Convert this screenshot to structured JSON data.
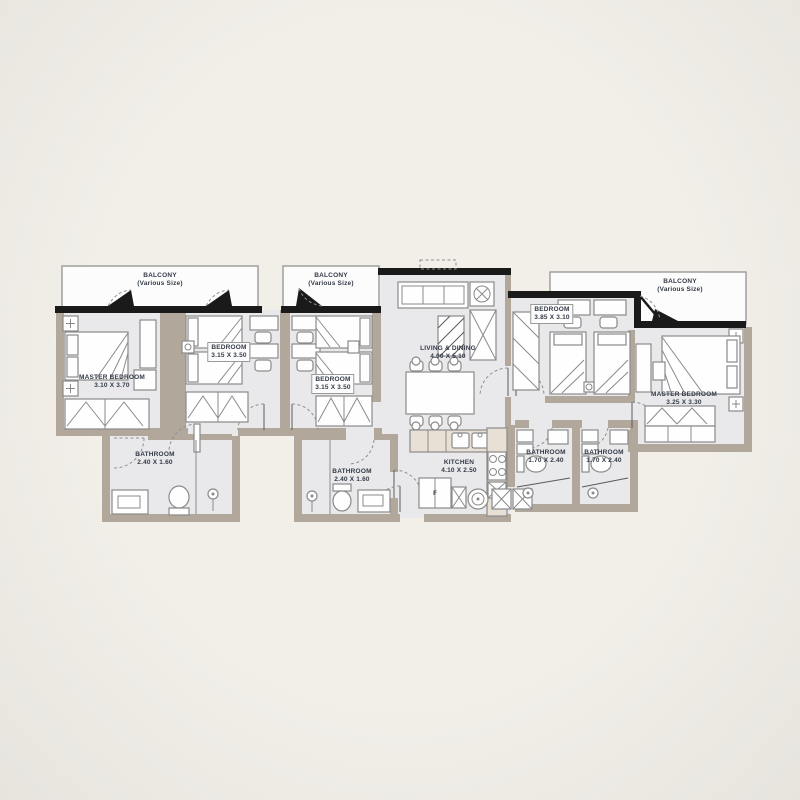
{
  "colors": {
    "outside": "#efece7",
    "floor": "#e9e9ec",
    "wall": "#b1a79b",
    "black": "#1a1a1a",
    "line": "#8a8a8a",
    "counter": "#e8e0d4",
    "text": "#333a47"
  },
  "plan": {
    "balcony_left": {
      "name": "BALCONY",
      "dims": "(Various Size)"
    },
    "balcony_mid": {
      "name": "BALCONY",
      "dims": "(Various Size)"
    },
    "balcony_right": {
      "name": "BALCONY",
      "dims": "(Various Size)"
    },
    "master_left": {
      "name": "MASTER BEDROOM",
      "dims": "3.10 X 3.70"
    },
    "bedroom_left": {
      "name": "BEDROOM",
      "dims": "3.15 X 3.50"
    },
    "bedroom_mid": {
      "name": "BEDROOM",
      "dims": "3.15 X 3.50"
    },
    "living": {
      "name": "LIVING & DINING",
      "dims": "4.00 X 5.10"
    },
    "bedroom_right": {
      "name": "BEDROOM",
      "dims": "3.85 X 3.10"
    },
    "master_right": {
      "name": "MASTER BEDROOM",
      "dims": "3.25 X 3.30"
    },
    "bathroom_left": {
      "name": "BATHROOM",
      "dims": "2.40 X 1.60"
    },
    "bathroom_mid": {
      "name": "BATHROOM",
      "dims": "2.40 X 1.60"
    },
    "bathroom_right1": {
      "name": "BATHROOM",
      "dims": "1.70 X 2.40"
    },
    "bathroom_right2": {
      "name": "BATHROOM",
      "dims": "1.70 X 2.40"
    },
    "kitchen": {
      "name": "KITCHEN",
      "dims": "4.10 X 2.50",
      "fridge_label": "F"
    }
  }
}
